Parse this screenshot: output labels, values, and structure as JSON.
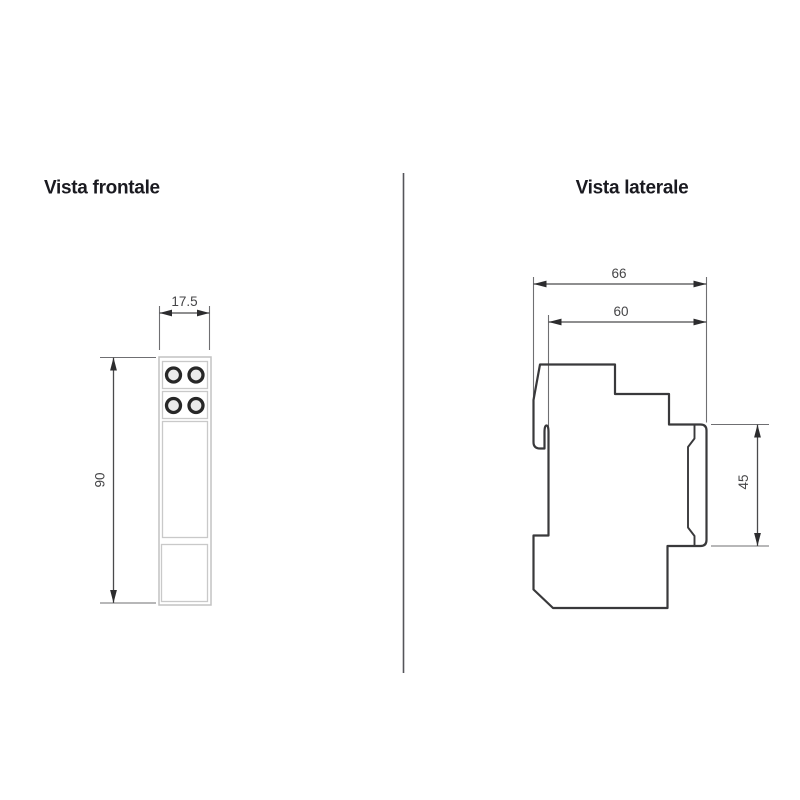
{
  "front_view": {
    "title": "Vista frontale",
    "width_dim": "17.5",
    "height_dim": "90"
  },
  "side_view": {
    "title": "Vista laterale",
    "total_depth_dim": "66",
    "body_depth_dim": "60",
    "front_height_dim": "45"
  },
  "colors": {
    "title_text": "#1a1a20",
    "dimension_text": "#454547",
    "outline": "#39393b",
    "light_outline": "#c9c9c9"
  }
}
